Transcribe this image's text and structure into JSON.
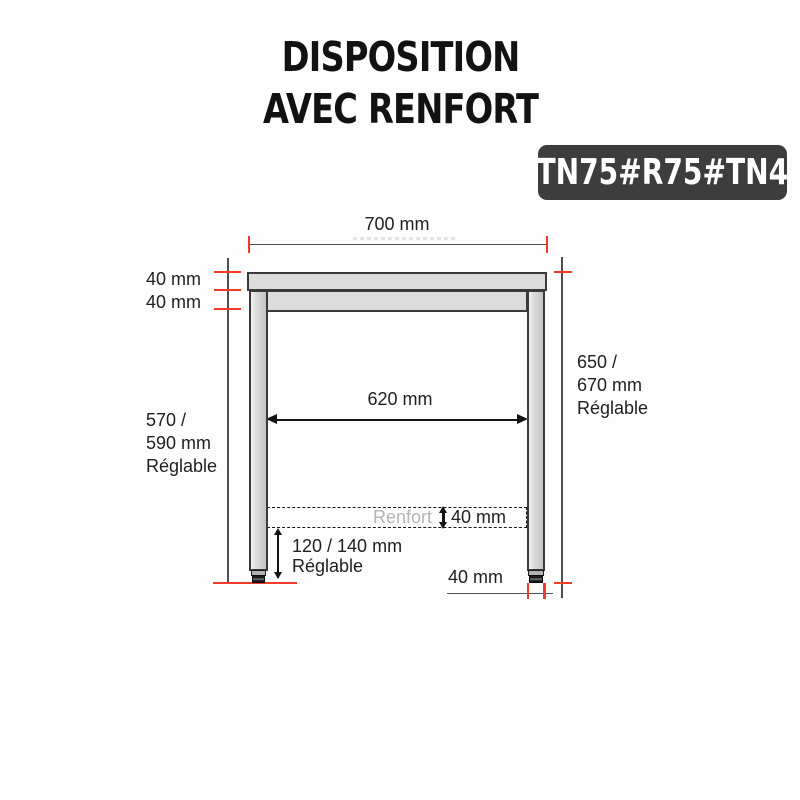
{
  "title": {
    "line1": "DISPOSITION",
    "line2": "AVEC RENFORT"
  },
  "badge": {
    "label": "TN75#R75#TN4"
  },
  "colors": {
    "badge_bg": "#3d3d3d",
    "badge_text": "#ffffff",
    "red_tick": "#f23b26",
    "dim_line": "#4f4f4f",
    "steel_fill": "#dcdcdc",
    "steel_border": "#3a3a3a",
    "arrow": "#141414",
    "label_text": "#1f1f1f",
    "muted_text": "#b5b5b5"
  },
  "labels": {
    "top_width": "700 mm",
    "top_thickness": "40 mm",
    "rail_thickness": "40 mm",
    "left_height_line1": "570 /",
    "left_height_line2": "590 mm",
    "left_height_line3": "Réglable",
    "right_height_line1": "650 /",
    "right_height_line2": "670 mm",
    "right_height_line3": "Réglable",
    "inner_width": "620 mm",
    "renfort": "Renfort",
    "renfort_thickness": "40 mm",
    "foot_adjust_line1": "120 / 140 mm",
    "foot_adjust_line2": "Réglable",
    "foot_width": "40 mm"
  }
}
